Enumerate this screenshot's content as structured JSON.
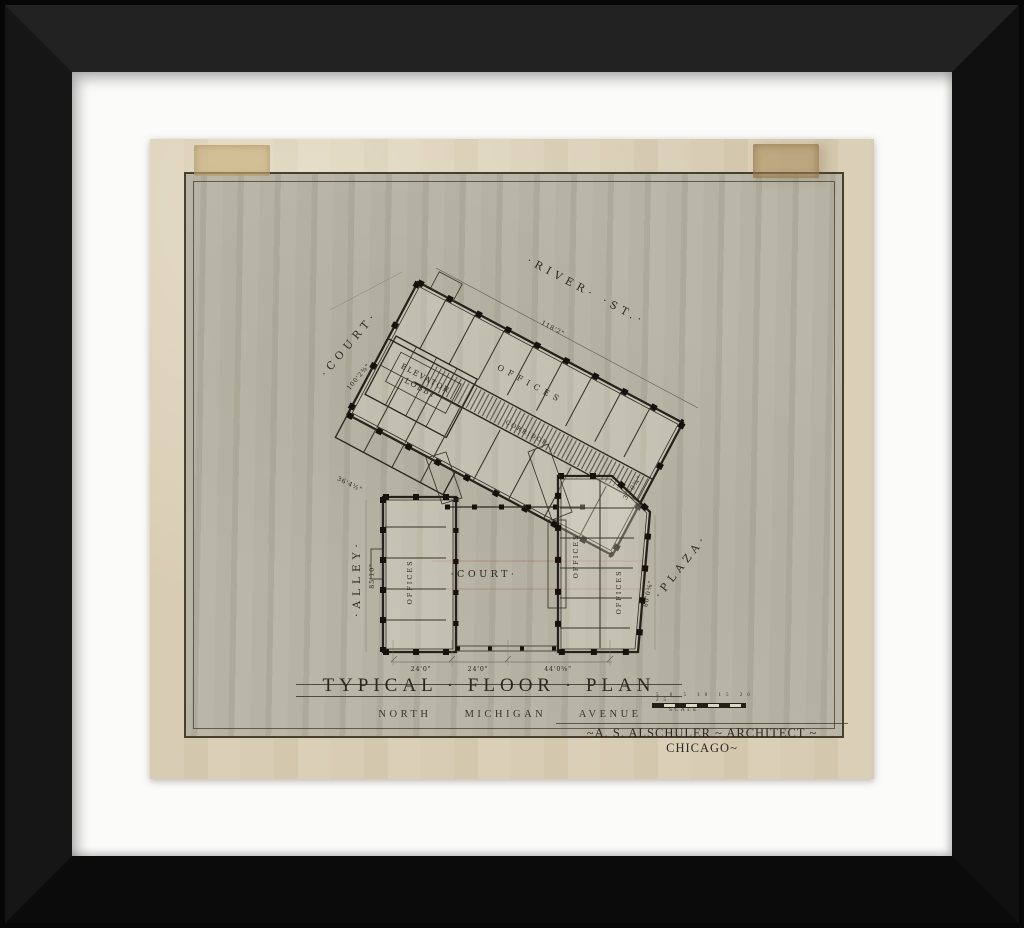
{
  "colors": {
    "frame": "#141414",
    "mat": "#fbfbfa",
    "paper": "#d8cdb4",
    "field": "#b5b1a3",
    "ink": "#2c2720",
    "tape": "#c3a977"
  },
  "plan": {
    "street_top": "·RIVER· ·ST.·",
    "street_left": "·COURT·",
    "street_alley": "·ALLEY·",
    "street_plaza": "·PLAZA·",
    "court": "·COURT·",
    "elevator_line1": "ELEVATOR",
    "elevator_line2": "LOBBY",
    "corridor": "CORRIDOR",
    "offices_wing": "OFFICES",
    "offices_left": "OFFICES",
    "offices_right_a": "OFFICES",
    "offices_right_b": "OFFICES",
    "dims": {
      "river": "118'2\"",
      "court": "100'2⅜\"",
      "alley": "85'10\"",
      "wing_left": "36'4½\"",
      "plaza_upper": "30'0¾\"",
      "plaza_lower": "80'0⅜\"",
      "bottom_left": "24'0\"",
      "bottom_mid": "24'0\"",
      "bottom_right": "44'0⅝\""
    }
  },
  "titleblock": {
    "title": "TYPICAL · FLOOR · PLAN",
    "subtitle": "NORTH MICHIGAN AVENUE",
    "architect": "~A. S. ALSCHULER ~ ARCHITECT ~ CHICAGO~",
    "scale_ticks": "5 0 5 10 15 20 25",
    "scale_label": "SCALE"
  }
}
